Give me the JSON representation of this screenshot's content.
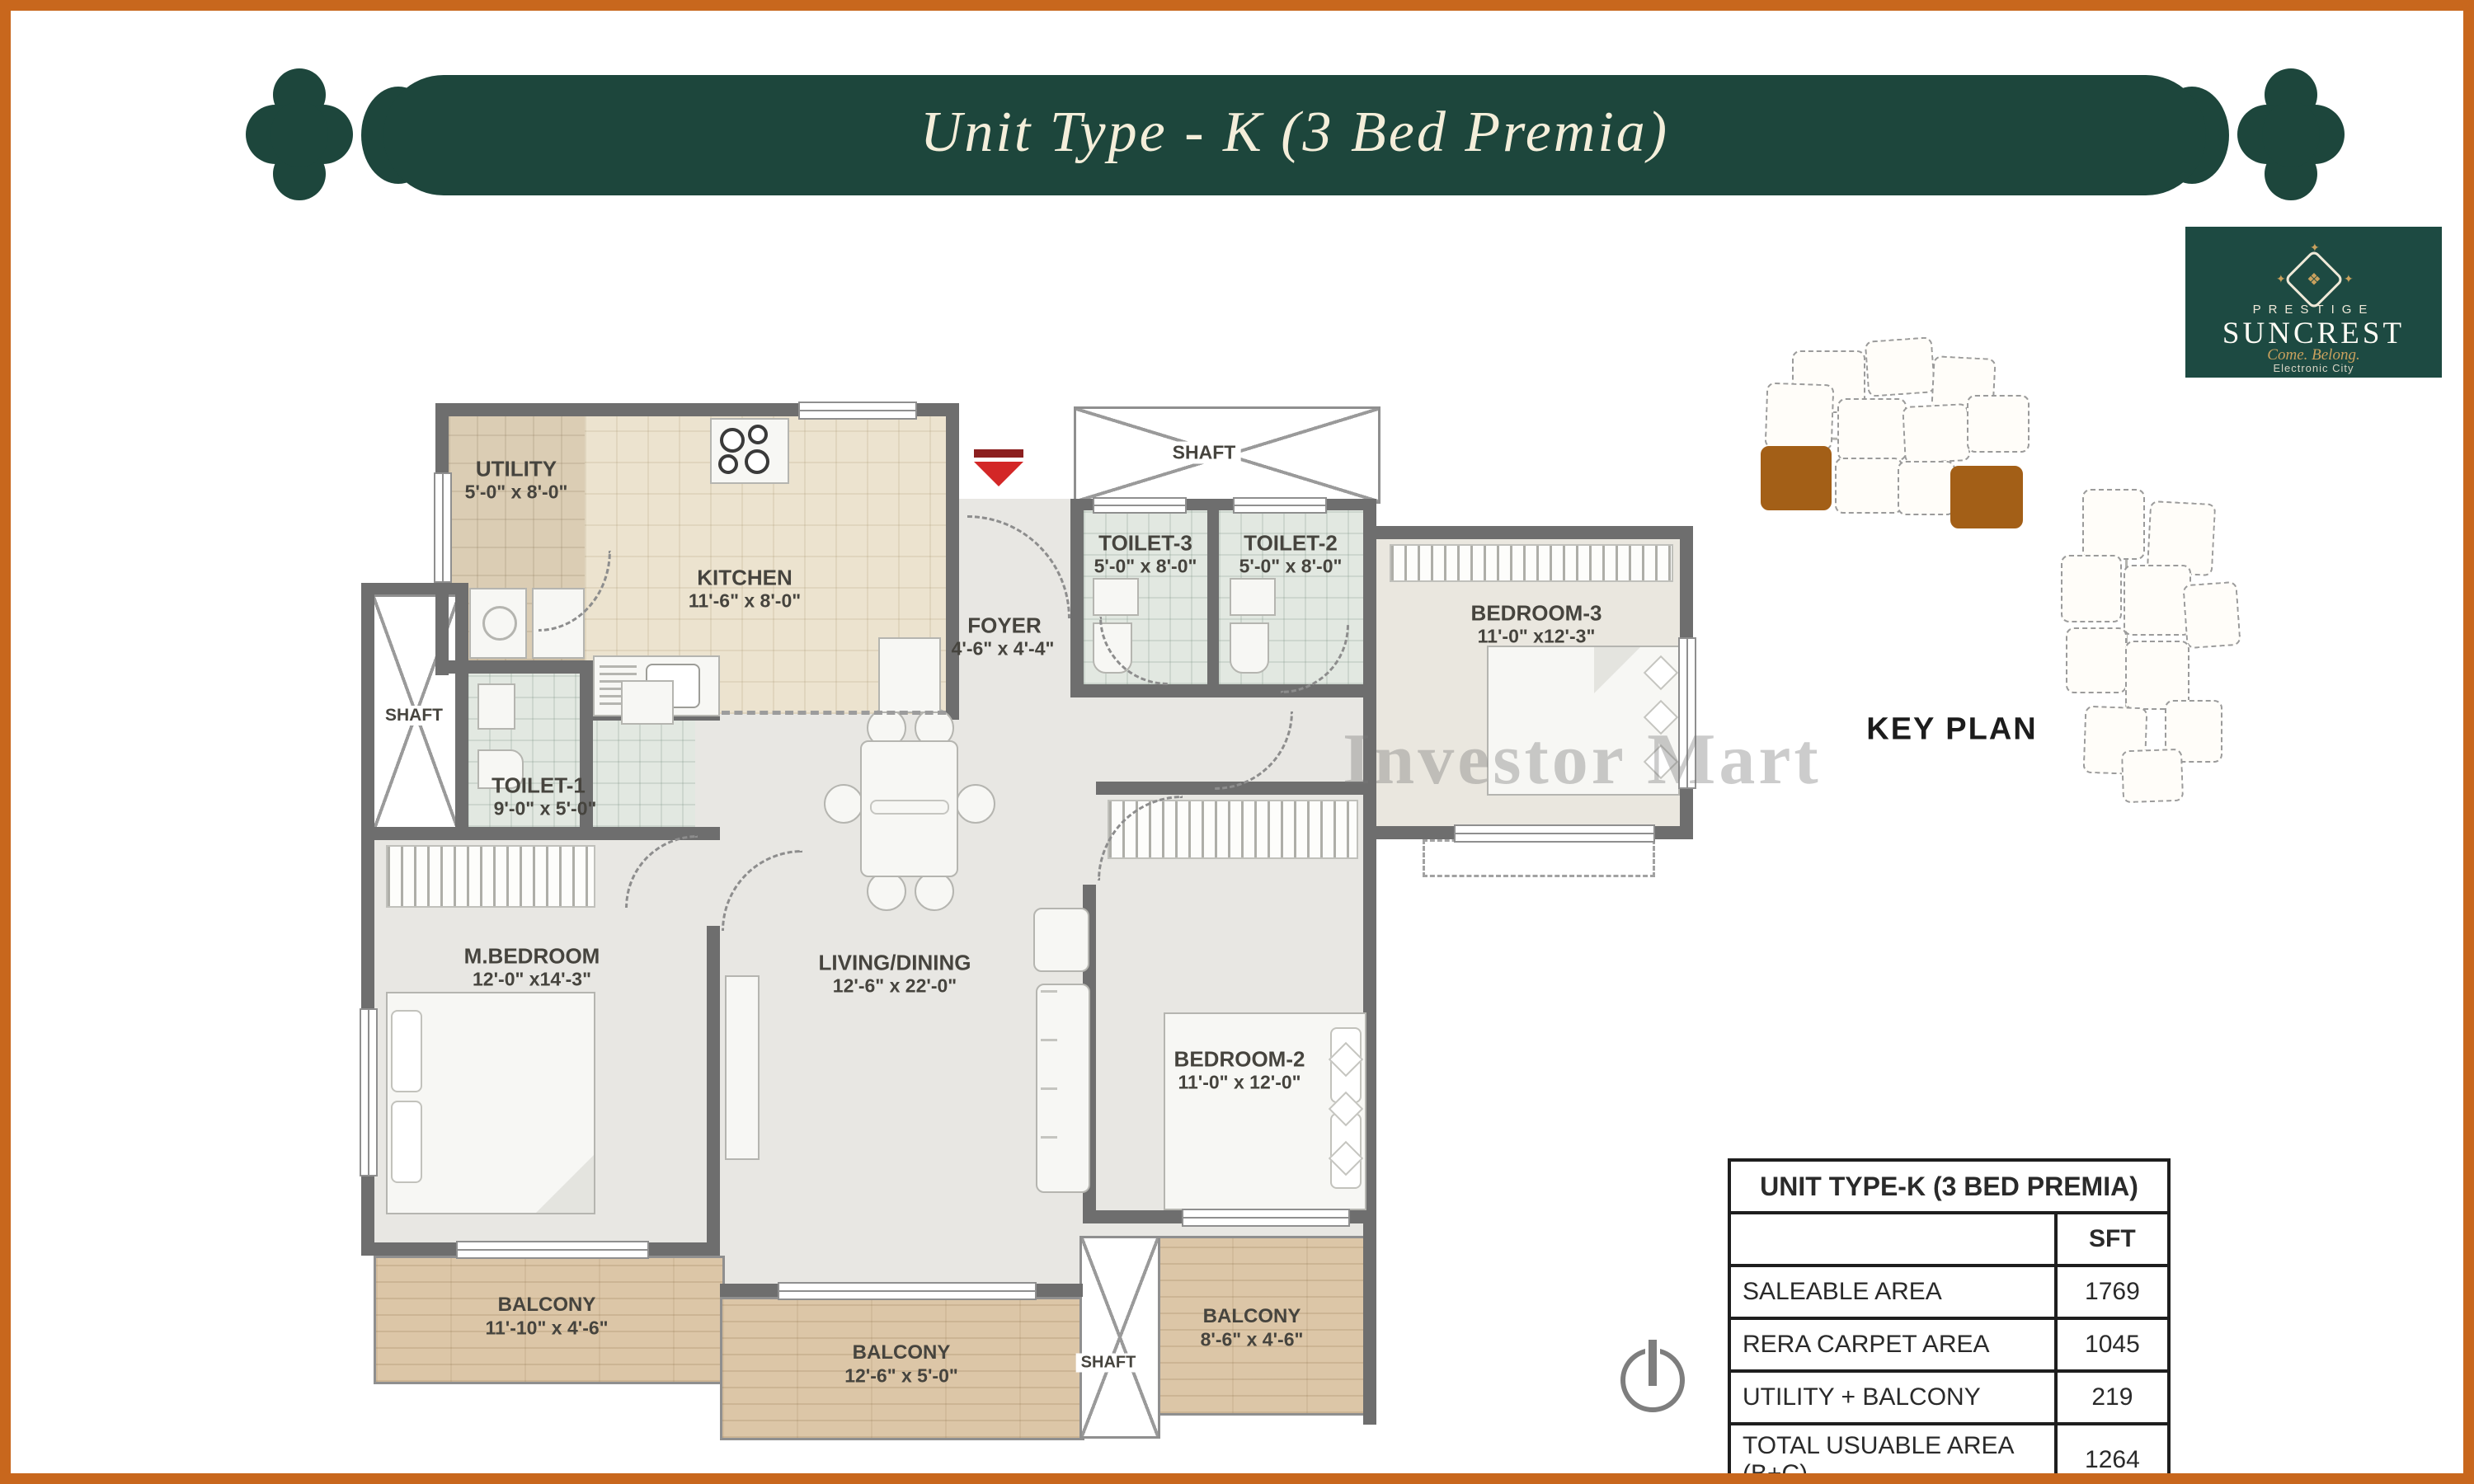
{
  "banner": {
    "title": "Unit Type - K (3 Bed Premia)",
    "bg_color": "#1d463c",
    "text_color": "#f4eeda"
  },
  "logo": {
    "brand": "PRESTIGE",
    "name": "SUNCREST",
    "tagline": "Come. Belong.",
    "location": "Electronic City",
    "bg_color": "#1d4a42",
    "gold_color": "#c9a15e"
  },
  "key_plan": {
    "label": "KEY PLAN",
    "highlight_color": "#a35f17"
  },
  "watermark": {
    "text": "Investor Mart"
  },
  "floor_plan": {
    "shaft_label": "SHAFT",
    "entry_arrow_color": "#d32727",
    "wall_color": "#6e6e6e",
    "rooms": [
      {
        "name": "UTILITY",
        "dims": "5'-0\" x 8'-0\""
      },
      {
        "name": "KITCHEN",
        "dims": "11'-6\" x 8'-0\""
      },
      {
        "name": "FOYER",
        "dims": "4'-6\" x 4'-4\""
      },
      {
        "name": "TOILET-3",
        "dims": "5'-0\" x 8'-0\""
      },
      {
        "name": "TOILET-2",
        "dims": "5'-0\" x 8'-0\""
      },
      {
        "name": "BEDROOM-3",
        "dims": "11'-0\" x12'-3\""
      },
      {
        "name": "TOILET-1",
        "dims": "9'-0\" x 5'-0\""
      },
      {
        "name": "M.BEDROOM",
        "dims": "12'-0\" x14'-3\""
      },
      {
        "name": "LIVING/DINING",
        "dims": "12'-6\" x 22'-0\""
      },
      {
        "name": "BEDROOM-2",
        "dims": "11'-0\" x 12'-0\""
      },
      {
        "name": "BALCONY",
        "dims": "11'-10\" x 4'-6\""
      },
      {
        "name": "BALCONY",
        "dims": "12'-6\" x 5'-0\""
      },
      {
        "name": "BALCONY",
        "dims": "8'-6\" x 4'-6\""
      }
    ]
  },
  "area_table": {
    "title": "UNIT TYPE-K (3 BED PREMIA)",
    "unit_header": "SFT",
    "rows": [
      {
        "label": "SALEABLE AREA",
        "value": "1769"
      },
      {
        "label": "RERA CARPET AREA",
        "value": "1045"
      },
      {
        "label": "UTILITY + BALCONY",
        "value": "219"
      },
      {
        "label": "TOTAL USUABLE AREA (B+C)",
        "value": "1264"
      }
    ]
  }
}
